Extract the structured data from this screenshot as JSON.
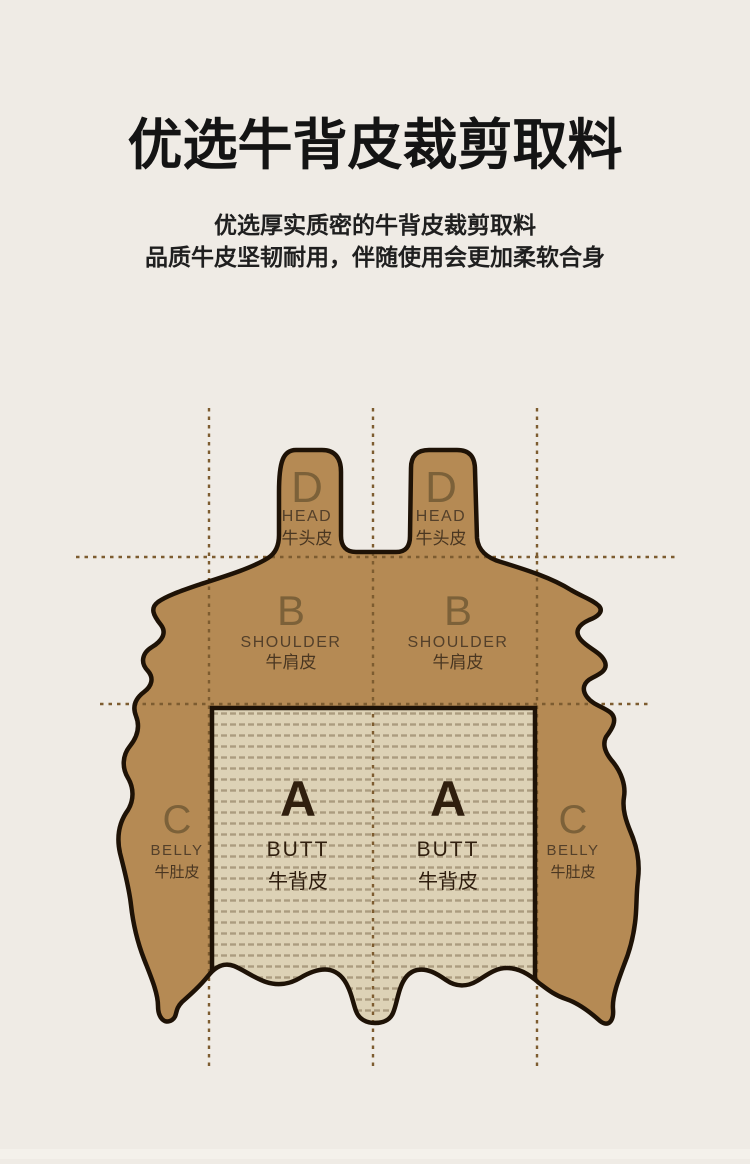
{
  "header": {
    "title": "优选牛背皮裁剪取料",
    "subtitle_line1": "优选厚实质密的牛背皮裁剪取料",
    "subtitle_line2": "品质牛皮坚韧耐用，伴随使用会更加柔软合身"
  },
  "diagram": {
    "sections": [
      {
        "id": "head-left",
        "letter": "D",
        "name_en": "HEAD",
        "name_cn": "牛头皮"
      },
      {
        "id": "head-right",
        "letter": "D",
        "name_en": "HEAD",
        "name_cn": "牛头皮"
      },
      {
        "id": "shoulder-left",
        "letter": "B",
        "name_en": "SHOULDER",
        "name_cn": "牛肩皮"
      },
      {
        "id": "shoulder-right",
        "letter": "B",
        "name_en": "SHOULDER",
        "name_cn": "牛肩皮"
      },
      {
        "id": "butt-left",
        "letter": "A",
        "name_en": "BUTT",
        "name_cn": "牛背皮"
      },
      {
        "id": "butt-right",
        "letter": "A",
        "name_en": "BUTT",
        "name_cn": "牛背皮"
      },
      {
        "id": "belly-left",
        "letter": "C",
        "name_en": "BELLY",
        "name_cn": "牛肚皮"
      },
      {
        "id": "belly-right",
        "letter": "C",
        "name_en": "BELLY",
        "name_cn": "牛肚皮"
      }
    ],
    "colors": {
      "background": "#efebe5",
      "hide_fill": "#b58a54",
      "hide_outline": "#1e1206",
      "butt_area_fill": "#ddd2b6",
      "butt_area_stripe": "#ab9c7f",
      "guide_dash": "#7d5c30",
      "section_letter": "#7c6139",
      "section_label_en": "#54402a",
      "section_label_cn": "#493621",
      "butt_text": "#301f0e",
      "title_text": "#141414"
    }
  }
}
